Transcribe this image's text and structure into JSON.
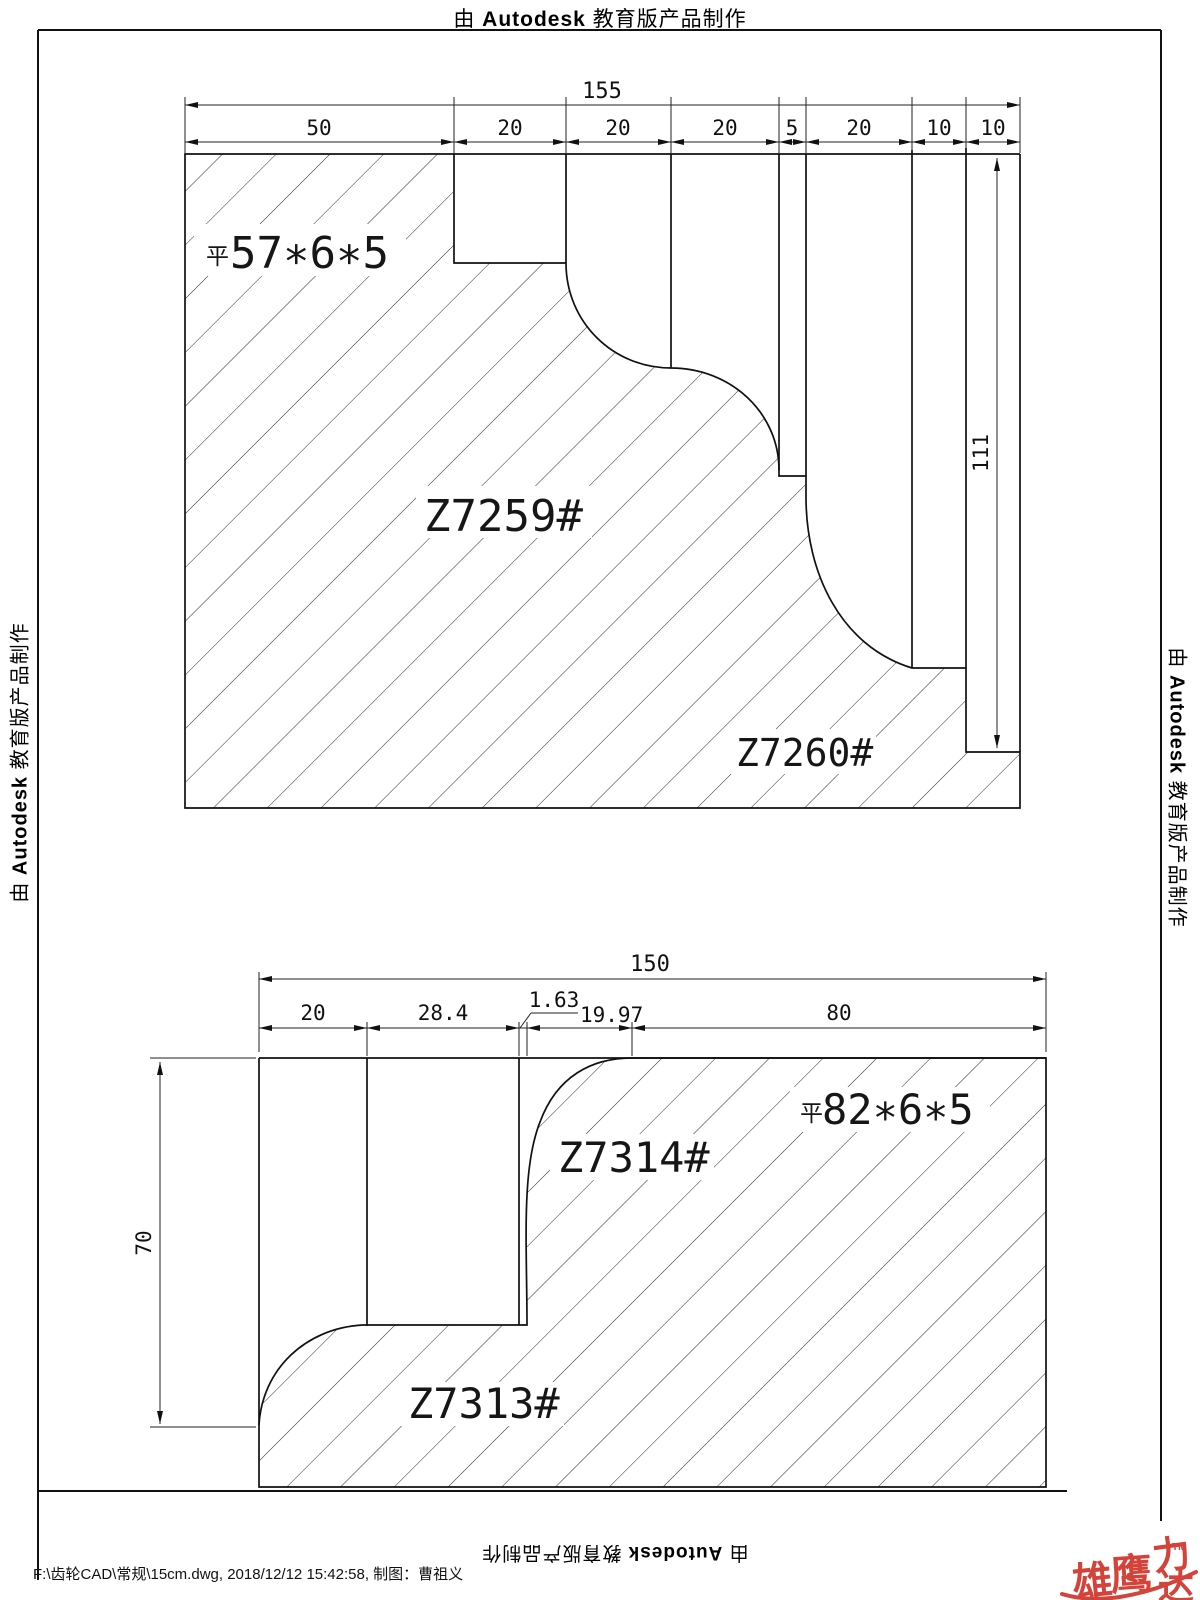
{
  "banner": {
    "prefix": "由",
    "brand": "Autodesk",
    "suffix": "教育版产品制作"
  },
  "footer": {
    "file_info": "F:\\齿轮CAD\\常规\\15cm.dwg, 2018/12/12 15:42:58, 制图：曹祖义"
  },
  "logo": {
    "c1": "雄",
    "c2": "鹰",
    "c3": "力",
    "c4": "达",
    "tm": "TM"
  },
  "top_drawing": {
    "key_prefix": "平",
    "key_spec": "57∗6∗5",
    "part_a": "Z7259#",
    "part_b": "Z7260#",
    "dim_total": "155",
    "segments": [
      "50",
      "20",
      "20",
      "20",
      "5",
      "20",
      "10",
      "10"
    ],
    "dim_height": "111"
  },
  "bottom_drawing": {
    "key_prefix": "平",
    "key_spec": "82∗6∗5",
    "part_a": "Z7314#",
    "part_b": "Z7313#",
    "dim_total": "150",
    "seg_a": "20",
    "seg_b": "28.4",
    "seg_c": "1.63",
    "seg_d": "19.97",
    "seg_e": "80",
    "dim_height": "70"
  },
  "colors": {
    "line": "#111111",
    "logo_red": "#d4433a"
  }
}
